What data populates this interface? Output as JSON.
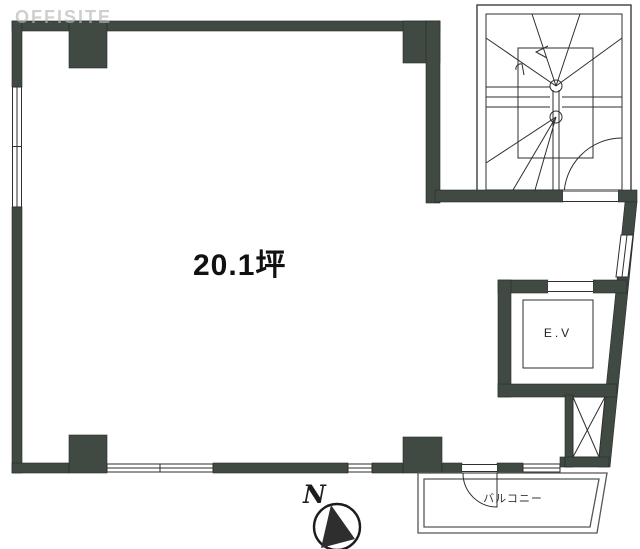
{
  "document": {
    "kind": "floor-plan"
  },
  "watermark": {
    "text": "OFFISITE"
  },
  "room": {
    "area_label": "20.1坪"
  },
  "elevator": {
    "label": "E.V"
  },
  "balcony": {
    "label": "バルコニー"
  },
  "compass": {
    "north_label": "N"
  },
  "colors": {
    "wall": "#404a42",
    "line": "#2e2e2e",
    "balcony_line": "#565656",
    "watermark": "#b3b8b3",
    "background": "#ffffff",
    "text": "#111111"
  }
}
